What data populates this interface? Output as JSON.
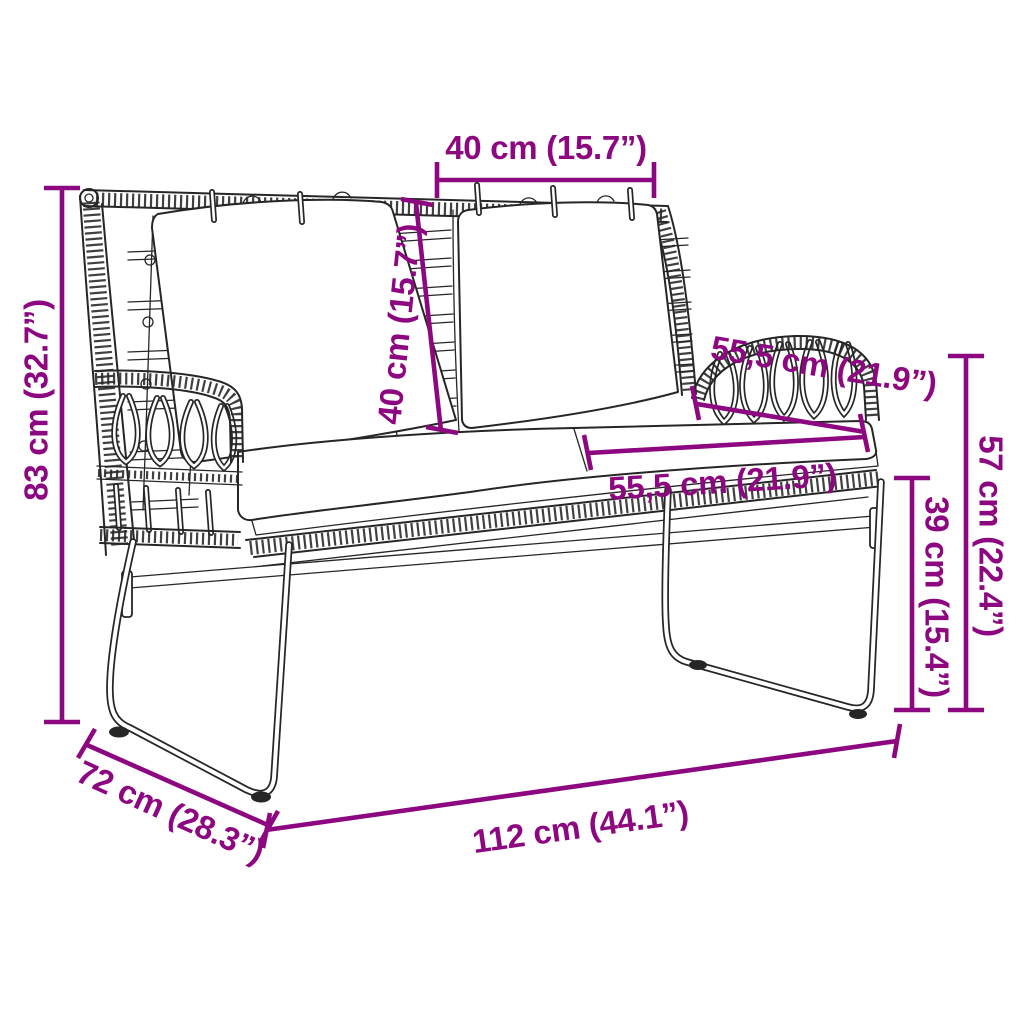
{
  "diagram": {
    "colors": {
      "dimension": "#8d0880",
      "line": "#262626",
      "background": "#ffffff"
    },
    "dimensions": [
      {
        "id": "overall-height",
        "label": "83 cm (32.7”)"
      },
      {
        "id": "backrest-cushion-width",
        "label": "40 cm (15.7”)"
      },
      {
        "id": "backrest-height",
        "label": "40 cm (15.7”)"
      },
      {
        "id": "armrest-side-depth",
        "label": "55,5 cm (21.9”)"
      },
      {
        "id": "seat-depth",
        "label": "55,5 cm (21.9”)"
      },
      {
        "id": "armrest-height",
        "label": "57 cm (22.4”)"
      },
      {
        "id": "seat-height",
        "label": "39 cm (15.4”)"
      },
      {
        "id": "overall-width",
        "label": "112 cm (44.1”)"
      },
      {
        "id": "overall-depth",
        "label": "72 cm (28.3”)"
      }
    ]
  }
}
